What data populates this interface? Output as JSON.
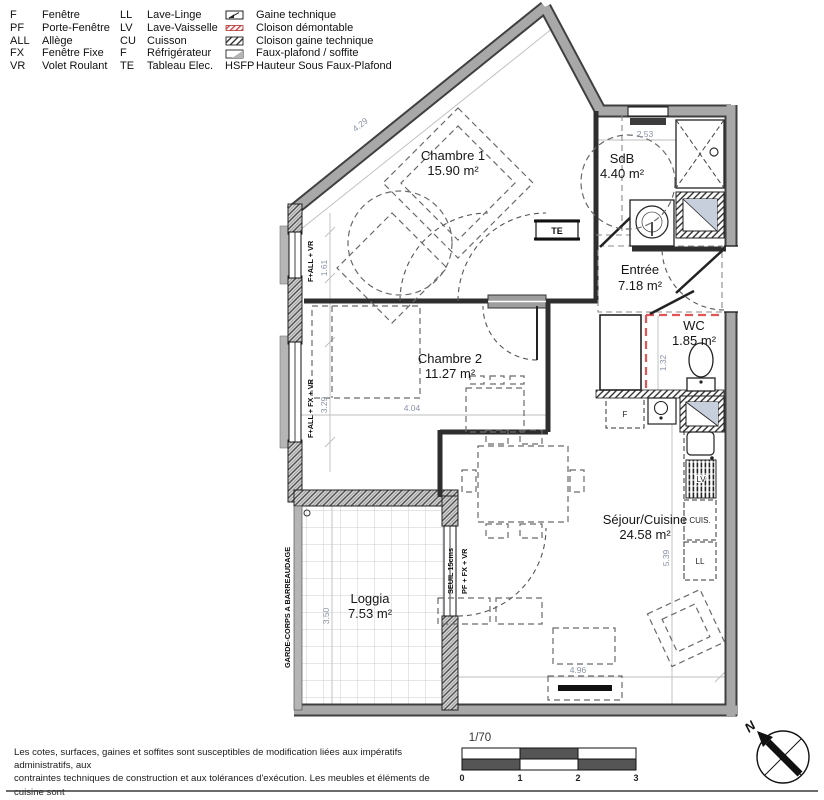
{
  "legend": {
    "abbreviations": [
      {
        "abbr": "F",
        "label": "Fenêtre"
      },
      {
        "abbr": "PF",
        "label": "Porte-Fenêtre"
      },
      {
        "abbr": "ALL",
        "label": "Allège"
      },
      {
        "abbr": "FX",
        "label": "Fenêtre Fixe"
      },
      {
        "abbr": "VR",
        "label": "Volet Roulant"
      },
      {
        "abbr": "LL",
        "label": "Lave-Linge"
      },
      {
        "abbr": "LV",
        "label": "Lave-Vaisselle"
      },
      {
        "abbr": "CU",
        "label": "Cuisson"
      },
      {
        "abbr": "F",
        "label": "Réfrigérateur"
      },
      {
        "abbr": "TE",
        "label": "Tableau Elec."
      }
    ],
    "symbols": [
      {
        "label": "Gaine technique"
      },
      {
        "label": "Cloison démontable"
      },
      {
        "label": "Cloison gaine technique"
      },
      {
        "label": "Faux-plafond / soffite"
      }
    ],
    "hsfp": {
      "abbr": "HSFP",
      "label": "Hauteur Sous Faux-Plafond"
    }
  },
  "rooms": {
    "chambre1": {
      "name": "Chambre 1",
      "area": "15.90 m²"
    },
    "sdb": {
      "name": "SdB",
      "area": "4.40 m²"
    },
    "entree": {
      "name": "Entrée",
      "area": "7.18 m²"
    },
    "wc": {
      "name": "WC",
      "area": "1.85 m²"
    },
    "chambre2": {
      "name": "Chambre 2",
      "area": "11.27 m²"
    },
    "sejour": {
      "name": "Séjour/Cuisine",
      "area": "24.58 m²"
    },
    "loggia": {
      "name": "Loggia",
      "area": "7.53 m²"
    }
  },
  "dimensions": {
    "diag": "4.29",
    "sdb_w": "2.53",
    "win1": "1.61",
    "win2": "3.29",
    "wc_h": "1.32",
    "ch2_w": "4.04",
    "loggia_h": "3.50",
    "sejour_h": "5.39",
    "sejour_w": "4.96"
  },
  "labels": {
    "garde_corps": "GARDE-CORPS A BARREAUDAGE",
    "seuil": "SEUIL 15cms",
    "pf_fx_vr": "PF + FX + VR",
    "f_all_vr": "F+ALL + VR",
    "f_all_fx_vr": "F+ALL + FX + VR",
    "te": "TE",
    "fridge": "F",
    "cuis": "CUIS.",
    "ll": "LL",
    "lv": "LV"
  },
  "footer": {
    "disclaimer_l1": "Les cotes, surfaces, gaines et soffites sont susceptibles de modification liées aux impératifs administratifs, aux",
    "disclaimer_l2": "contraintes techniques de construction et aux tolérances d'exécution. Les meubles et éléments de cuisine sont",
    "disclaimer_l3": "représentés à titre indicatif. Seuls seront fournis les équipements sur le descriptif annexé à l'acte de vente.",
    "scale": "1/70",
    "ticks": {
      "t0": "0",
      "t1": "1",
      "t2": "2",
      "t3": "3"
    },
    "north": "N"
  }
}
